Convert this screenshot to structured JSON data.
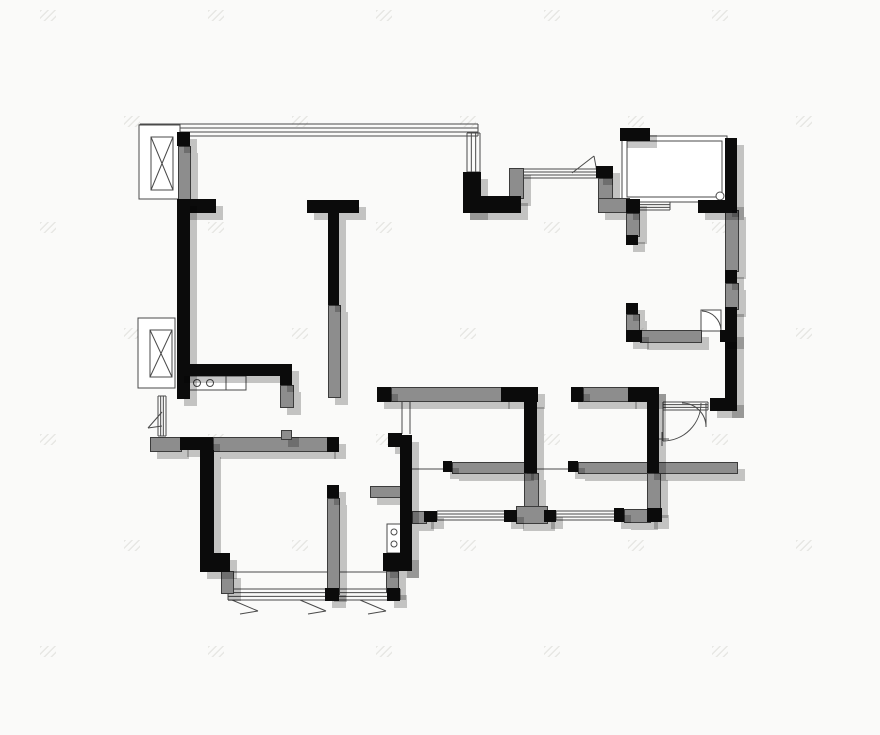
{
  "title": "apartment-floor-plan",
  "canvas": {
    "width": 880,
    "height": 735
  },
  "colors": {
    "background": "#fafaf9",
    "wall_black": "#0b0b0b",
    "wall_gray": "#8d8d8d",
    "thin_line": "#4a4a4a",
    "shadow": "rgba(0,0,0,0.22)",
    "watermark": "#e7e7e4"
  },
  "plan": {
    "walls_black": [
      [
        177,
        132,
        13,
        14
      ],
      [
        178,
        199,
        38,
        14
      ],
      [
        177,
        199,
        13,
        200
      ],
      [
        177,
        364,
        106,
        12
      ],
      [
        280,
        364,
        12,
        21
      ],
      [
        307,
        200,
        52,
        13
      ],
      [
        328,
        213,
        11,
        92
      ],
      [
        463,
        172,
        18,
        41
      ],
      [
        463,
        196,
        58,
        17
      ],
      [
        596,
        166,
        17,
        12
      ],
      [
        626,
        199,
        14,
        14
      ],
      [
        620,
        128,
        30,
        13
      ],
      [
        698,
        200,
        39,
        13
      ],
      [
        725,
        138,
        12,
        72
      ],
      [
        725,
        270,
        12,
        13
      ],
      [
        725,
        307,
        12,
        104
      ],
      [
        710,
        398,
        27,
        13
      ],
      [
        626,
        235,
        12,
        10
      ],
      [
        626,
        303,
        12,
        11
      ],
      [
        626,
        330,
        16,
        12
      ],
      [
        720,
        330,
        17,
        12
      ],
      [
        377,
        387,
        14,
        15
      ],
      [
        501,
        387,
        37,
        15
      ],
      [
        571,
        387,
        12,
        15
      ],
      [
        628,
        387,
        31,
        15
      ],
      [
        647,
        387,
        12,
        86
      ],
      [
        524,
        400,
        13,
        73
      ],
      [
        388,
        433,
        14,
        14
      ],
      [
        400,
        435,
        12,
        136
      ],
      [
        383,
        553,
        29,
        18
      ],
      [
        180,
        437,
        33,
        13
      ],
      [
        327,
        437,
        12,
        15
      ],
      [
        200,
        450,
        14,
        105
      ],
      [
        200,
        553,
        30,
        19
      ],
      [
        327,
        485,
        12,
        13
      ],
      [
        325,
        588,
        14,
        13
      ],
      [
        387,
        588,
        13,
        13
      ],
      [
        424,
        511,
        13,
        11
      ],
      [
        504,
        510,
        13,
        12
      ],
      [
        544,
        510,
        12,
        12
      ],
      [
        614,
        508,
        10,
        14
      ],
      [
        647,
        508,
        15,
        14
      ],
      [
        443,
        461,
        9,
        11
      ],
      [
        568,
        461,
        10,
        11
      ]
    ],
    "walls_gray": [
      [
        178,
        146,
        11,
        53
      ],
      [
        509,
        168,
        13,
        29
      ],
      [
        598,
        178,
        13,
        22
      ],
      [
        598,
        198,
        30,
        13
      ],
      [
        626,
        213,
        12,
        22
      ],
      [
        626,
        314,
        12,
        17
      ],
      [
        640,
        330,
        60,
        11
      ],
      [
        725,
        210,
        12,
        60
      ],
      [
        725,
        283,
        12,
        25
      ],
      [
        328,
        305,
        11,
        91
      ],
      [
        280,
        385,
        12,
        21
      ],
      [
        150,
        437,
        30,
        13
      ],
      [
        213,
        437,
        114,
        13
      ],
      [
        281,
        430,
        9,
        8
      ],
      [
        327,
        498,
        11,
        95
      ],
      [
        221,
        571,
        11,
        21
      ],
      [
        386,
        571,
        11,
        20
      ],
      [
        391,
        387,
        110,
        13
      ],
      [
        583,
        387,
        45,
        13
      ],
      [
        370,
        486,
        32,
        10
      ],
      [
        412,
        511,
        13,
        11
      ],
      [
        524,
        473,
        13,
        33
      ],
      [
        516,
        506,
        30,
        16
      ],
      [
        452,
        462,
        73,
        10
      ],
      [
        578,
        462,
        158,
        10
      ],
      [
        647,
        473,
        12,
        36
      ],
      [
        624,
        509,
        25,
        12
      ]
    ],
    "windows": [
      {
        "x": 140,
        "y": 124,
        "w": 338,
        "h": 12,
        "dir": "h"
      },
      {
        "x": 467,
        "y": 133,
        "w": 13,
        "h": 39,
        "dir": "v"
      },
      {
        "x": 521,
        "y": 169,
        "w": 78,
        "h": 9,
        "dir": "h"
      },
      {
        "x": 638,
        "y": 202,
        "w": 32,
        "h": 8,
        "dir": "h"
      },
      {
        "x": 158,
        "y": 396,
        "w": 8,
        "h": 40,
        "dir": "v"
      },
      {
        "x": 228,
        "y": 589,
        "w": 172,
        "h": 11,
        "dir": "h"
      },
      {
        "x": 437,
        "y": 511,
        "w": 68,
        "h": 9,
        "dir": "h"
      },
      {
        "x": 556,
        "y": 511,
        "w": 62,
        "h": 9,
        "dir": "h"
      },
      {
        "x": 663,
        "y": 402,
        "w": 45,
        "h": 8,
        "dir": "h"
      }
    ],
    "thin_rects": [
      {
        "x": 139,
        "y": 125,
        "w": 41,
        "h": 74,
        "name": "flue-box-frame"
      },
      {
        "x": 138,
        "y": 318,
        "w": 37,
        "h": 70,
        "name": "flue-box-frame"
      },
      {
        "x": 622,
        "y": 136,
        "w": 105,
        "h": 66,
        "name": "balcony-frame-outer"
      },
      {
        "x": 627,
        "y": 141,
        "w": 95,
        "h": 56,
        "name": "balcony-frame-inner"
      },
      {
        "x": 186,
        "y": 376,
        "w": 40,
        "h": 14,
        "name": "kitchen-stove"
      },
      {
        "x": 226,
        "y": 376,
        "w": 20,
        "h": 14,
        "name": "kitchen-sink"
      },
      {
        "x": 387,
        "y": 524,
        "w": 14,
        "h": 29,
        "name": "water-heater"
      },
      {
        "x": 701,
        "y": 310,
        "w": 20,
        "h": 21,
        "name": "door-leaf-panel"
      }
    ],
    "xboxes": [
      {
        "x": 151,
        "y": 137,
        "w": 22,
        "h": 53
      },
      {
        "x": 150,
        "y": 330,
        "w": 22,
        "h": 47
      }
    ],
    "circles": [
      {
        "cx": 720,
        "cy": 196,
        "r": 4,
        "name": "floor-drain"
      },
      {
        "cx": 197,
        "cy": 383,
        "r": 3.5,
        "name": "burner"
      },
      {
        "cx": 210,
        "cy": 383,
        "r": 3.5,
        "name": "burner"
      },
      {
        "cx": 394,
        "cy": 532,
        "r": 3,
        "name": "valve"
      },
      {
        "cx": 394,
        "cy": 544,
        "r": 3,
        "name": "valve"
      }
    ],
    "lines": [
      [
        402,
        402,
        402,
        434
      ],
      [
        410,
        402,
        410,
        434
      ],
      [
        412,
        469,
        570,
        469
      ],
      [
        230,
        572,
        386,
        572
      ],
      [
        572,
        173,
        594,
        156
      ],
      [
        594,
        156,
        597,
        172
      ],
      [
        162,
        412,
        148,
        428
      ],
      [
        148,
        428,
        162,
        426
      ],
      [
        232,
        600,
        258,
        611
      ],
      [
        240,
        614,
        258,
        611
      ],
      [
        300,
        600,
        326,
        611
      ],
      [
        308,
        614,
        326,
        611
      ],
      [
        360,
        600,
        386,
        611
      ],
      [
        368,
        614,
        386,
        611
      ],
      [
        655,
        439,
        669,
        439
      ],
      [
        662,
        432,
        662,
        446
      ],
      [
        663,
        403,
        663,
        441
      ],
      [
        706,
        403,
        706,
        427
      ]
    ],
    "arcs": [
      {
        "d": "M663,441 A38,38 0 0 0 701,403",
        "name": "entry-door-swing-arc"
      },
      {
        "d": "M682,403 A24,24 0 0 1 706,427",
        "name": "entry-door-second-leaf-arc"
      },
      {
        "d": "M702,311 A20,20 0 0 1 721,330",
        "name": "room-door-swing-arc"
      }
    ],
    "watermark": {
      "cols": 6,
      "rows": 7,
      "dx": 168,
      "dy": 106,
      "stagger": 84,
      "x0": 40,
      "y0": 10
    }
  }
}
